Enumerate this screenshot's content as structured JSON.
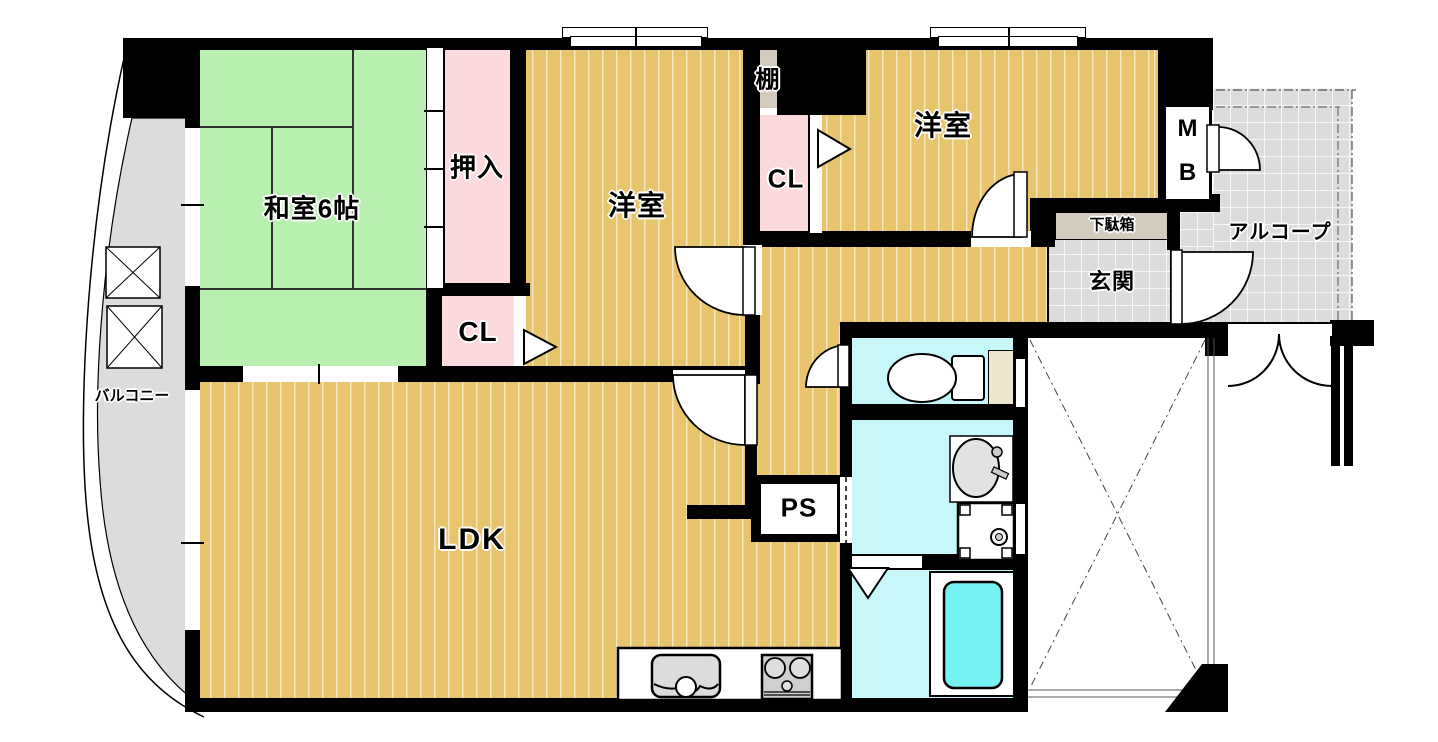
{
  "labels": {
    "washitsu": "和室6帖",
    "oshiire": "押入",
    "closet_left": "CL",
    "western_center": "洋室",
    "shelf": "棚",
    "closet_center": "CL",
    "western_right": "洋室",
    "meter_box_m": "M",
    "meter_box_b": "B",
    "alcove": "アルコープ",
    "shoe_cabinet": "下駄箱",
    "entrance": "玄関",
    "balcony": "バルコニー",
    "ldk": "LDK",
    "pipe_space": "PS"
  },
  "colors": {
    "wood_floor": "#e8c56d",
    "tatami": "#b8f0b0",
    "closet_pink": "#fbd9dd",
    "shelf_beige": "#d2cabc",
    "tile_gray": "#dcdcdc",
    "bath_cyan": "#c8f7f9",
    "bathtub": "#76f1f3",
    "wall": "#000000"
  }
}
